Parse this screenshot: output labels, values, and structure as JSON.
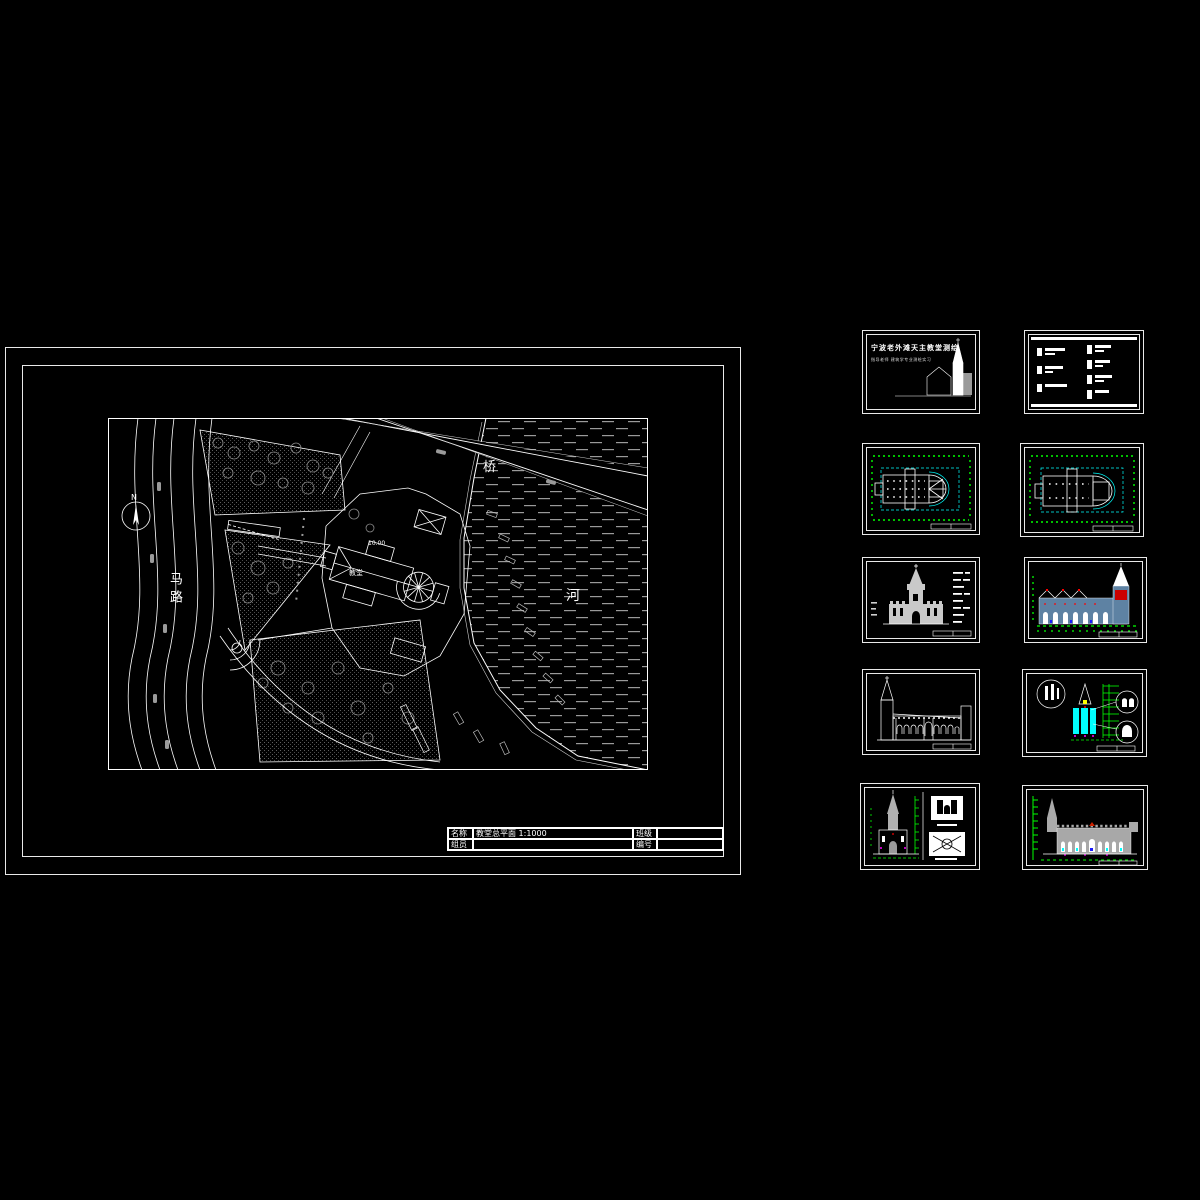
{
  "main_sheet": {
    "plan_labels": {
      "compass": "N",
      "road": "马路",
      "bridge": "桥",
      "river": "河",
      "level": "10.00",
      "building": "教堂"
    },
    "title_block": {
      "r1c1": "名称",
      "r1c2": "教堂总平面  1:1000",
      "r1c3": "班级",
      "r1c4": "",
      "r2c1": "组员",
      "r2c2": "",
      "r2c3": "编号",
      "r2c4": ""
    }
  },
  "cover_sheet": {
    "title": "宁波老外滩天主教堂测绘",
    "subtitle": "指导老师  建筑学专业测绘实习"
  },
  "colors": {
    "line": "#ffffff",
    "dim_green": "#00ff00",
    "axis_cyan": "#00ffff",
    "accent_red": "#ff0000",
    "accent_magenta": "#ff00ff",
    "body_blue": "#5e82a3",
    "gray": "#9a9a9a",
    "background": "#000000"
  }
}
